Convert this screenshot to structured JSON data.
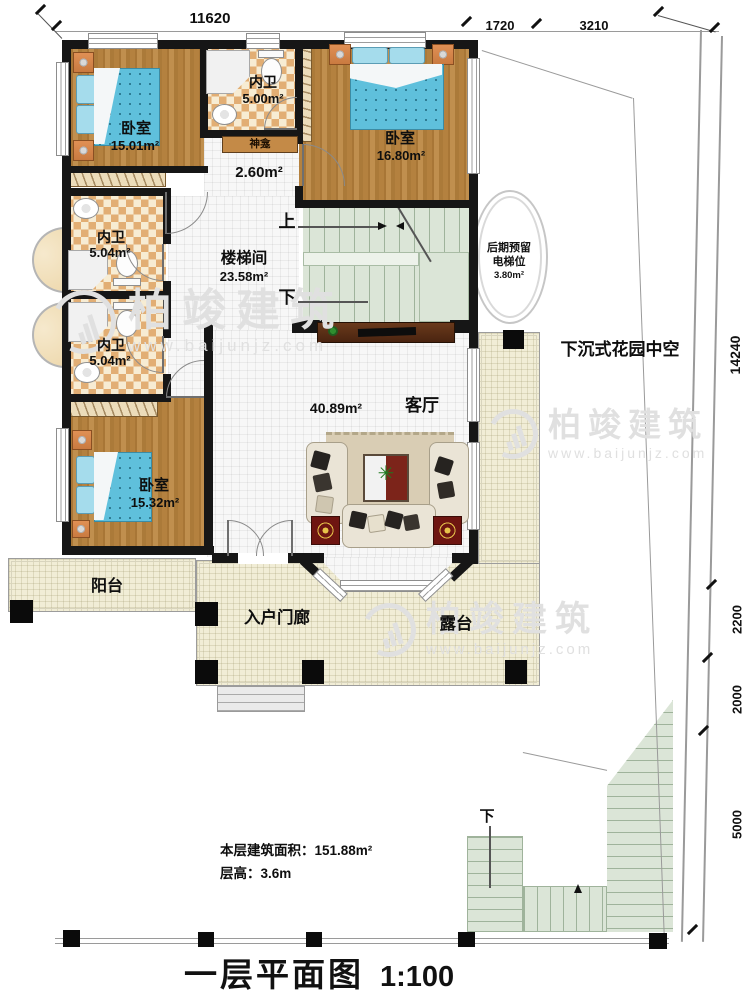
{
  "title": {
    "name": "一层平面图",
    "scale": "1:100"
  },
  "summary": {
    "area": "本层建筑面积：151.88m²",
    "floor_height": "层高：3.6m"
  },
  "dims": {
    "top": [
      "11620",
      "1720",
      "3210"
    ],
    "right": [
      "14240",
      "2200",
      "2000",
      "5000"
    ]
  },
  "rooms": {
    "bedroom1": {
      "name": "卧室",
      "area": "15.01m²"
    },
    "bath_top": {
      "name": "内卫",
      "area": "5.00m²"
    },
    "shrine": {
      "name": "神龛",
      "area": "2.60m²"
    },
    "bedroom2": {
      "name": "卧室",
      "area": "16.80m²"
    },
    "bath_mid": {
      "name": "内卫",
      "area": "5.04m²"
    },
    "bath_low": {
      "name": "内卫",
      "area": "5.04m²"
    },
    "stair_hall": {
      "name": "楼梯间",
      "area": "23.58m²"
    },
    "bedroom3": {
      "name": "卧室",
      "area": "15.32m²"
    },
    "living": {
      "name": "客厅",
      "area": "40.89m²"
    },
    "elevator": {
      "line1": "后期预留",
      "line2": "电梯位",
      "area": "3.80m²"
    },
    "garden": {
      "name": "下沉式花园中空"
    },
    "balcony": {
      "name": "阳台"
    },
    "porch": {
      "name": "入户门廊"
    },
    "terrace": {
      "name": "露台"
    }
  },
  "stair_marks": {
    "up": "上",
    "down": "下",
    "outdoor_down": "下"
  },
  "watermark": {
    "brand": "柏竣建筑",
    "url": "www.baijunjz.com"
  },
  "colors": {
    "wall": "#161616",
    "wood": "#b4813f",
    "tile": "#e2ae74",
    "bed": "#5fc0dc",
    "stair": "#dbe5d7",
    "outdoor": "#f1edd6"
  }
}
